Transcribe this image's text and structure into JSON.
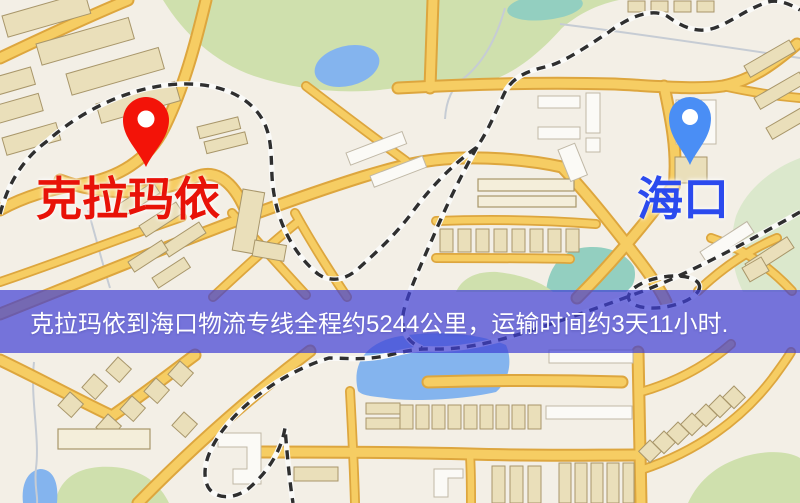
{
  "colors": {
    "origin_label": "#e81208",
    "origin_pin": "#f31308",
    "destination_label": "#2b4aee",
    "destination_pin": "#4a8ef5",
    "banner_background": "rgba(62,62,212,0.70)",
    "banner_text": "#ffffff"
  },
  "origin": {
    "label": "克拉玛依"
  },
  "destination": {
    "label": "海口"
  },
  "banner": {
    "text": "克拉玛依到海口物流专线全程约5244公里，运输时间约3天11小时."
  },
  "route": {
    "distance": "5244公里",
    "duration": "3天11小时"
  }
}
